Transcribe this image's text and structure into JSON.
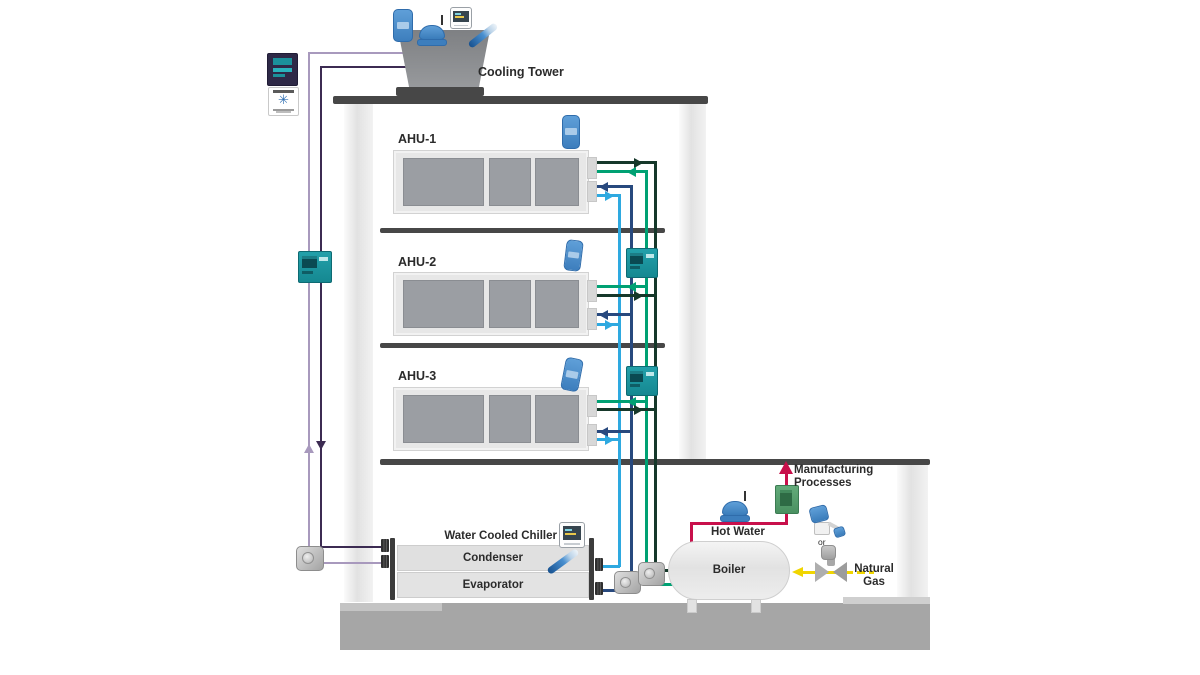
{
  "diagram_title": "Building HVAC, chiller, boiler and process heating system diagram",
  "labels": {
    "cooling_tower": "Cooling Tower",
    "ahu_1": "AHU-1",
    "ahu_2": "AHU-2",
    "ahu_3": "AHU-3",
    "water_cooled_chiller": "Water Cooled Chiller",
    "condenser": "Condenser",
    "evaporator": "Evaporator",
    "boiler": "Boiler",
    "hot_water": "Hot Water",
    "manufacturing_processes": "Manufacturing Processes",
    "natural_gas": "Natural Gas",
    "or": "or"
  },
  "colors": {
    "text": "#2b2b2b",
    "structure": "#474747",
    "concrete": "#a6a6a6",
    "panel_gray": "#9b9ea3",
    "equipment_gray": "#8f9194",
    "condenser_supply_purple": "#3c2b52",
    "condenser_return_purple": "#a899bd",
    "chilled_supply_blue": "#28497e",
    "chilled_return_blue": "#2ea9e0",
    "hot_supply_green": "#00a173",
    "hot_return_green": "#16382a",
    "process_hot_red": "#c8104b",
    "natural_gas_yellow": "#f0d500",
    "device_teal": "#1b919b",
    "device_blue": "#4a8fd0",
    "device_green": "#55a06b"
  },
  "icons": {
    "wireless_sensor": "blue rounded transmitter",
    "wireless_pump_transmitter": "blue dome with antenna",
    "gateway_display": "white box with dark screen",
    "pen_probe": "blue tapered probe",
    "riser_controller": "teal controller with dark display",
    "building_controller": "dark controller with teal display",
    "software_logo_card": "white card with blue snowflake ✳",
    "process_controller": "green controller",
    "pump": "gray inline pump",
    "flange": "black pipe flange",
    "gas_valve": "gray bowtie valve",
    "gas_regulator": "gray regulator",
    "gas_transmitter": "blue-on-white valve transmitter"
  }
}
